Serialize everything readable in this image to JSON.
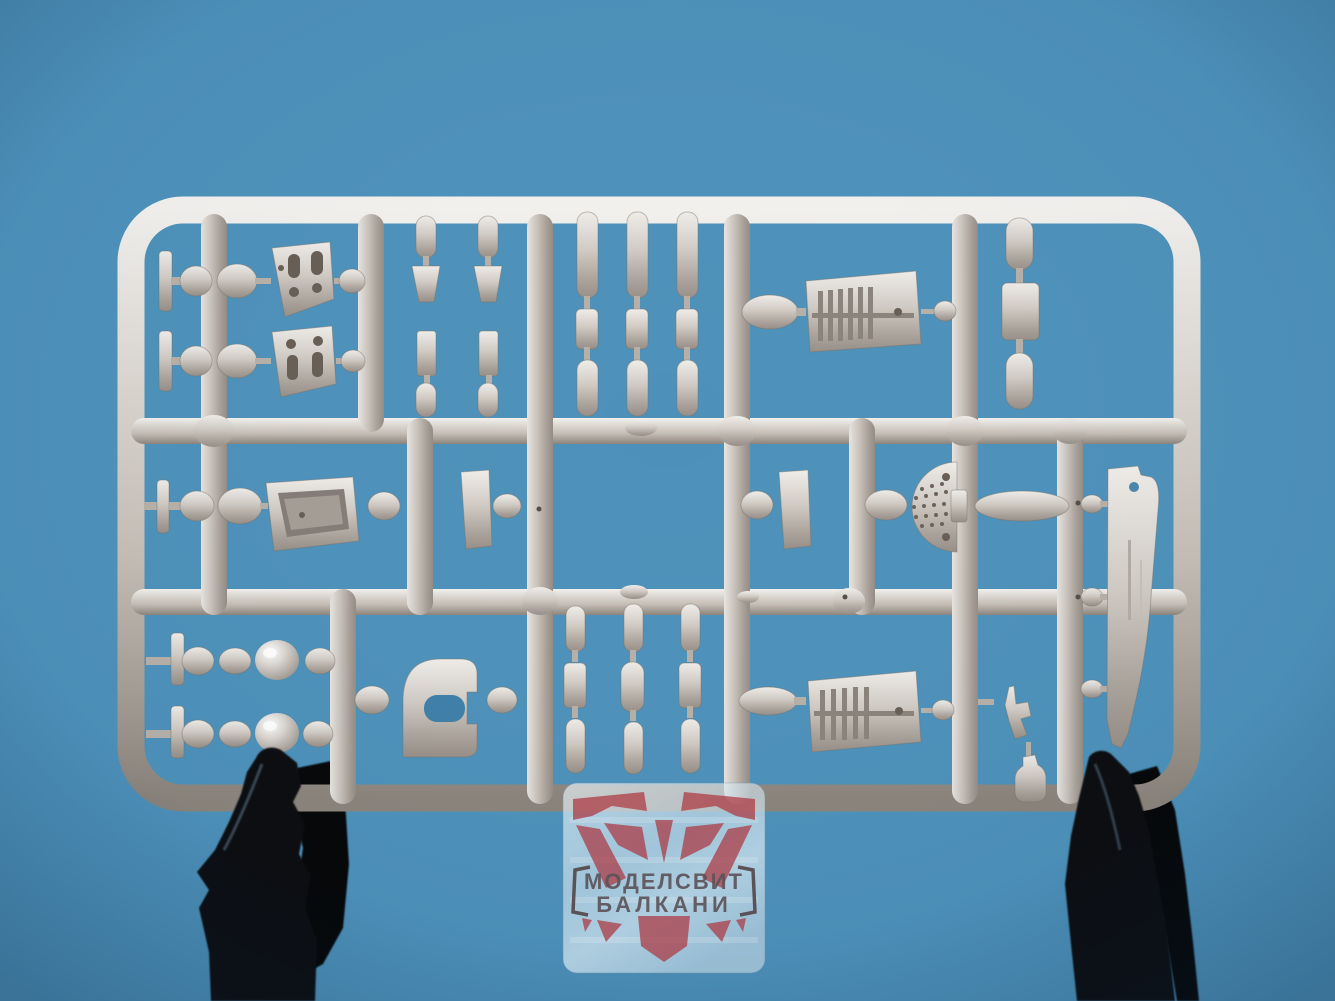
{
  "image": {
    "type": "photograph",
    "subject": "Light grey injection-molded model kit sprue held by two black clips against a blue background, with a semi-transparent brand watermark plate at bottom center"
  },
  "watermark": {
    "line1": "МОДЕЛСВИТ",
    "line2": "БАЛКАНИ",
    "brand_latin": "Modelsvit Balkani"
  },
  "colors": {
    "background": "#4d91ba",
    "background_deep": "#3f80a8",
    "plastic_light": "#f0ede9",
    "plastic_mid": "#c9c2bb",
    "plastic_dark": "#8f8780",
    "hole_dark": "#675e55",
    "clip_black": "#0c0d10",
    "clip_black_deep": "#060708",
    "plate_tint": "#d9ebf4",
    "emblem_red": "#b1454e",
    "emblem_text": "#5c4f53"
  },
  "sprue": {
    "frame_shape": "rounded rectangle",
    "plastic_color_name": "light grey",
    "parts_visible": [
      "panel-with-openings",
      "tank-half-pill",
      "trapezoid-tab",
      "ribbed-cooler-plate",
      "perforated-half-disc",
      "cockpit-tub",
      "door-with-oval-opening",
      "float-blade",
      "pearl-ball",
      "t-shaped-stub",
      "gun-pitot",
      "bottle-part",
      "oval-lump"
    ]
  },
  "clips": {
    "count": 2,
    "description": "black plastic holding clips at bottom"
  }
}
